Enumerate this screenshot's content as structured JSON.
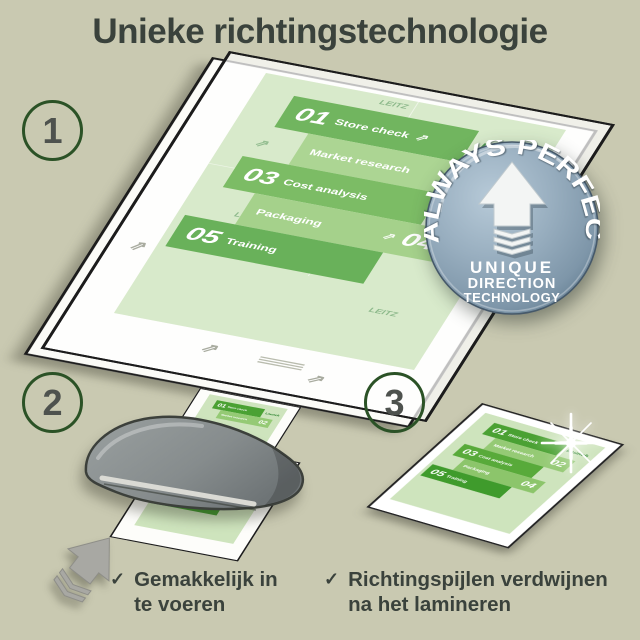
{
  "title": "Unieke richtingstechnologie",
  "steps": [
    {
      "number": "1"
    },
    {
      "number": "2"
    },
    {
      "number": "3"
    }
  ],
  "badge": {
    "arc_text": "ALWAYS PERFECT!",
    "line1": "UNIQUE",
    "line2": "DIRECTION",
    "line3": "TECHNOLOGY"
  },
  "document": {
    "brand_watermark": "LEITZ",
    "launch_label": "Launch",
    "direction_arrow_glyph": "⇗",
    "items": [
      {
        "num": "01",
        "label": "Store check"
      },
      {
        "num": "02",
        "label": "Market research"
      },
      {
        "num": "03",
        "label": "Cost analysis"
      },
      {
        "num": "04",
        "label": "Packaging"
      },
      {
        "num": "05",
        "label": "Training"
      }
    ]
  },
  "captions": [
    {
      "check": "✓",
      "line1": "Gemakkelijk in",
      "line2": "te voeren"
    },
    {
      "check": "✓",
      "line1": "Richtingspijlen verdwijnen",
      "line2": "na het lamineren"
    }
  ],
  "colors": {
    "background": "#c9c9b1",
    "text": "#3a423c",
    "circle_stroke": "#2b5226",
    "doc_green_dark": "#4aa133",
    "doc_green_medium": "#95ca75",
    "doc_sheet_green": "#cee4bd",
    "badge_blue": "#8ca3b6",
    "machine_grey": "#868c8d"
  }
}
